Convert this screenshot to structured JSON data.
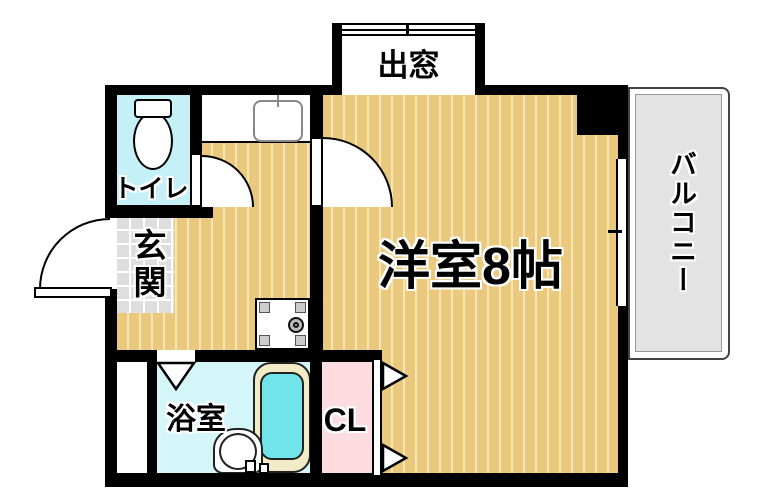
{
  "title": "floorplan",
  "rooms": {
    "toilet": {
      "label": "トイレ"
    },
    "entrance": {
      "label": "玄関"
    },
    "bay_window": {
      "label": "出窓"
    },
    "main_room": {
      "label": "洋室8帖"
    },
    "balcony": {
      "label": "バルコニー"
    },
    "bathroom": {
      "label": "浴室"
    },
    "closet": {
      "label": "CL"
    }
  },
  "fixtures": {
    "toilet": "toilet-icon",
    "kitchen_sink": "kitchen-sink-icon",
    "washing_machine_pan": "washing-machine-pan-icon",
    "bathtub": "bathtub-icon",
    "washbasin": "washbasin-icon",
    "doors": "door-swing-icon",
    "folding_doors": "folding-door-triangle-icon"
  },
  "colors": {
    "wall": "#000000",
    "flooring": "#eac87d",
    "flooring_stripe": "#f8e7b2",
    "tile": "#dedede",
    "tile_line": "#ffffff",
    "toilet_room": "#c6f0f8",
    "bathroom": "#d4f6f8",
    "bathtub_rim": "#f2ebc6",
    "bathtub_water": "#70e4e9",
    "closet": "#fcdce1",
    "balcony": "#e3e3e3"
  }
}
